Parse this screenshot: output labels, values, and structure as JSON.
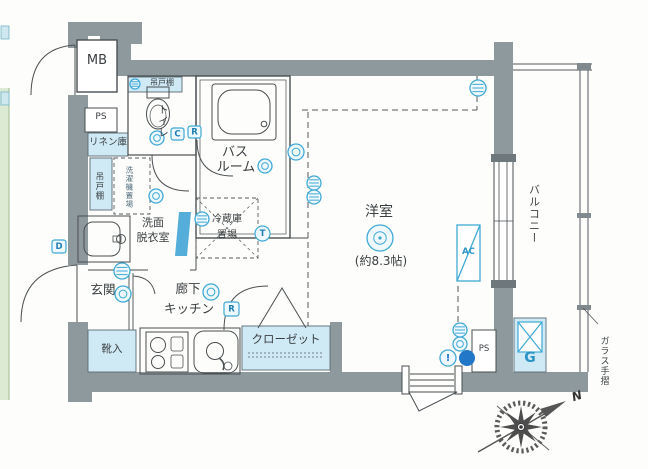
{
  "plan": {
    "mb": "MB",
    "ps_top": "PS",
    "linen": "リネン庫",
    "cupboard_top": "吊戸棚",
    "toilet": "トイレ",
    "bath_line1": "バス",
    "bath_line2": "ルーム",
    "washing_machine": "洗濯機置場",
    "cupboard_left": "吊戸棚",
    "washroom_line1": "洗面",
    "washroom_line2": "脱衣室",
    "fridge_line1": "冷蔵庫",
    "fridge_line2": "置場",
    "entrance": "玄関",
    "corridor": "廊下",
    "kitchen": "キッチン",
    "shoe_box": "靴入",
    "closet": "クローゼット",
    "main_room": "洋室",
    "main_room_size": "(約8.3帖)",
    "balcony": "バルコニー",
    "glass_rail": "ガラス手摺",
    "ac_unit": "AC",
    "water_heater": "G",
    "ps_bottom": "PS"
  },
  "badges": {
    "c": "C",
    "r_toilet": "R",
    "r_kitchen": "R",
    "d": "D",
    "t": "T",
    "alert": "!"
  },
  "compass": {
    "north": "N"
  },
  "colors": {
    "wall": "#8e999e",
    "fixture_fill": "#cfe9f5",
    "accent": "#3fa9d5",
    "deep_blue": "#2277c9",
    "line": "#4a4f52"
  }
}
